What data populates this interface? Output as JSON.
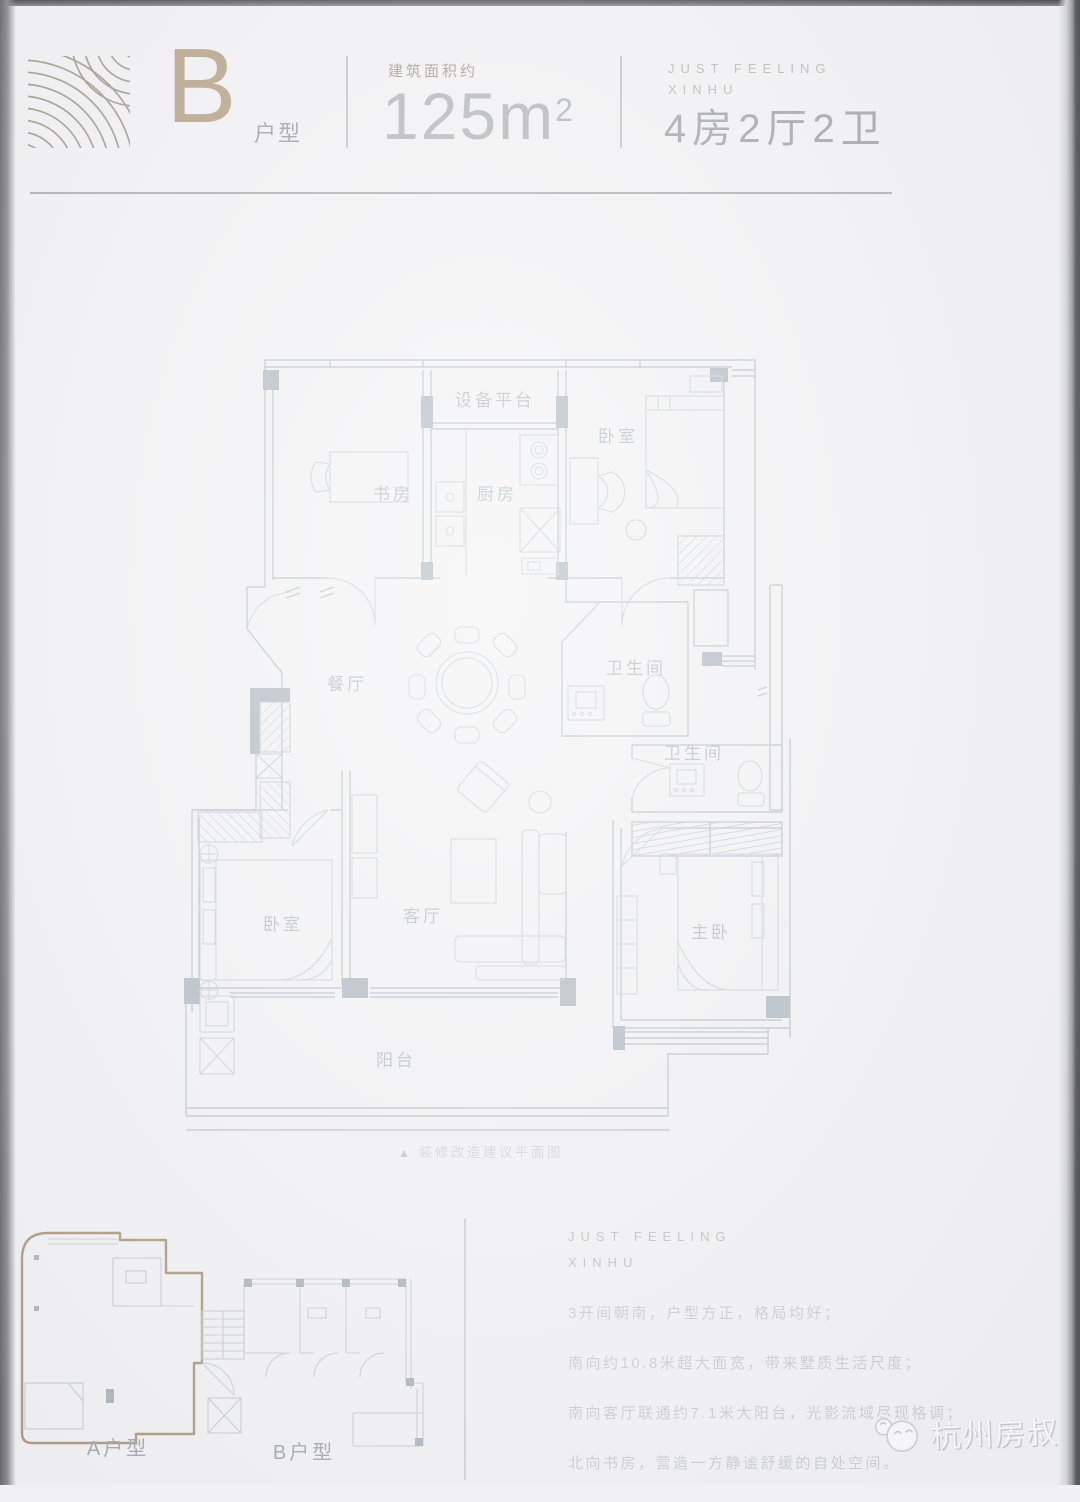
{
  "header": {
    "unit_letter": "B",
    "unit_suffix": "户型",
    "area_label": "建筑面积约",
    "area_value": "125m",
    "area_sup": "2",
    "brand": [
      "JUST FEELING",
      "XINHU"
    ],
    "layout": "4房2厅2卫"
  },
  "plan": {
    "caption_marker": "▲",
    "caption": "装修改造建议平面图",
    "labels": {
      "equipment_platform": "设备平台",
      "study": "书房",
      "kitchen": "厨房",
      "bedroom_north": "卧室",
      "dining": "餐厅",
      "bathroom_1": "卫生间",
      "bathroom_2": "卫生间",
      "bedroom_south": "卧室",
      "living": "客厅",
      "master_bedroom": "主卧",
      "balcony": "阳台"
    }
  },
  "keyplan": {
    "unit_a_label": "A户型",
    "unit_b_label": "B户型"
  },
  "description": {
    "brand": [
      "JUST FEELING",
      "XINHU"
    ],
    "lines": [
      "3开间朝南，户型方正，格局均好；",
      "南向约10.8米超大面宽，带来墅质生活尺度；",
      "南向客厅联通约7.1米大阳台，光影流域尽现格调；",
      "北向书房，营造一方静谧舒缓的自处空间。"
    ]
  },
  "watermark": {
    "text": "杭州房叔"
  },
  "colors": {
    "accent_brown": "#a68e6d",
    "keyplan_brown": "#9c8365",
    "plan_line": "#b2bdc6",
    "muted_text": "#8e9093"
  }
}
